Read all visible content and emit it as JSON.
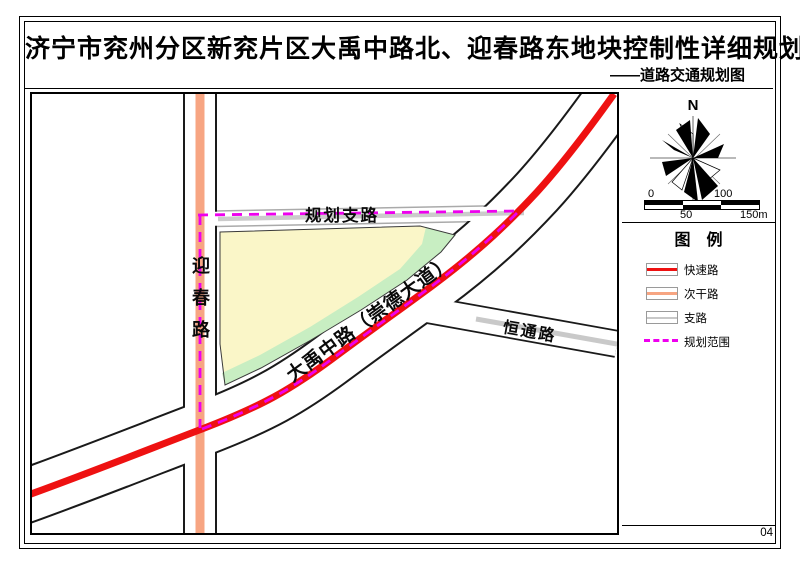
{
  "title": {
    "main": "济宁市兖州分区新兖片区大禹中路北、迎春路东地块控制性详细规划",
    "subtitle": "——道路交通规划图"
  },
  "map": {
    "labels": {
      "yingchun": "迎春路",
      "dayu": "大禹中路（崇德大道）",
      "hengtong": "恒通路",
      "planned_branch": "规划支路"
    }
  },
  "sidebar": {
    "north": "N",
    "scalebar": {
      "t0": "0",
      "t50": "50",
      "t100": "100",
      "t150": "150m"
    },
    "legend_title": "图　例",
    "legend": [
      {
        "label": "快速路",
        "color": "#ee1111",
        "style": "solid"
      },
      {
        "label": "次干路",
        "color": "#f7a582",
        "style": "solid"
      },
      {
        "label": "支路",
        "color": "#c8c8c8",
        "style": "solid"
      },
      {
        "label": "规划范围",
        "color": "#ee00ee",
        "style": "dashed"
      }
    ],
    "sheet_number": "04"
  },
  "colors": {
    "expressway": "#ee1111",
    "secondary_road": "#f7a582",
    "branch_road": "#c9c9c9",
    "planned_branch_road": "#cbcbcb",
    "planning_boundary": "#ee00ee",
    "parcel_yellow": "#faf6c8",
    "parcel_green": "#c8eec2",
    "road_casing": "#1a1a1a"
  }
}
